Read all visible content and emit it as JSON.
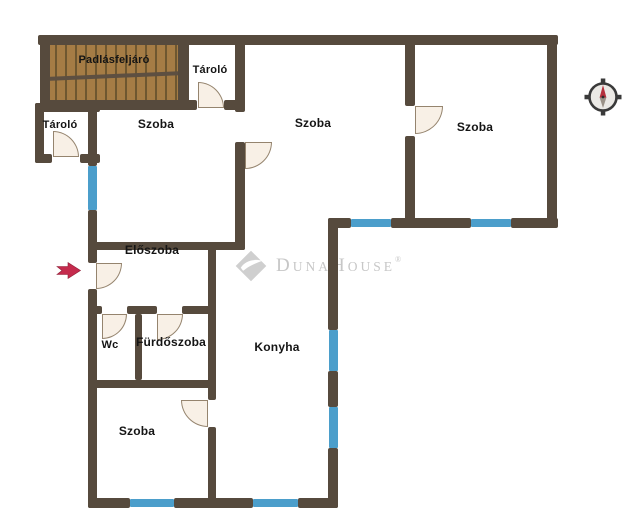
{
  "plan": {
    "type": "apartment-floor-plan",
    "rooms": [
      {
        "id": "padlasfeljaro",
        "label": "Padlásfeljáró"
      },
      {
        "id": "tarolo-top",
        "label": "Tároló"
      },
      {
        "id": "tarolo-left",
        "label": "Tároló"
      },
      {
        "id": "szoba-top-left",
        "label": "Szoba"
      },
      {
        "id": "szoba-top-middle",
        "label": "Szoba"
      },
      {
        "id": "szoba-top-right",
        "label": "Szoba"
      },
      {
        "id": "eloszoba",
        "label": "Előszoba"
      },
      {
        "id": "wc",
        "label": "Wc"
      },
      {
        "id": "furdoszoba",
        "label": "Fürdőszoba"
      },
      {
        "id": "konyha",
        "label": "Konyha"
      },
      {
        "id": "szoba-bottom",
        "label": "Szoba"
      }
    ],
    "colors": {
      "wall": "#564a3d",
      "window": "#4b9ecb",
      "wood": "#a57c45",
      "wood_line": "#6e5730",
      "wood_border": "#5d4f41",
      "door_fill": "#f8f0e6",
      "door_border": "#95846e",
      "watermark": "#c7c7c7",
      "arrow": "#c52b4d",
      "compass_dark": "#3a3a3a",
      "compass_fill": "#ebe9e5",
      "compass_needle": "#b5303d"
    },
    "icons": [
      "entrance-arrow-icon",
      "compass-icon"
    ]
  },
  "watermark": {
    "part1_initial": "D",
    "part1_rest": "UNA",
    "part2_initial": "H",
    "part2_rest": "OUSE",
    "registered": "®"
  }
}
